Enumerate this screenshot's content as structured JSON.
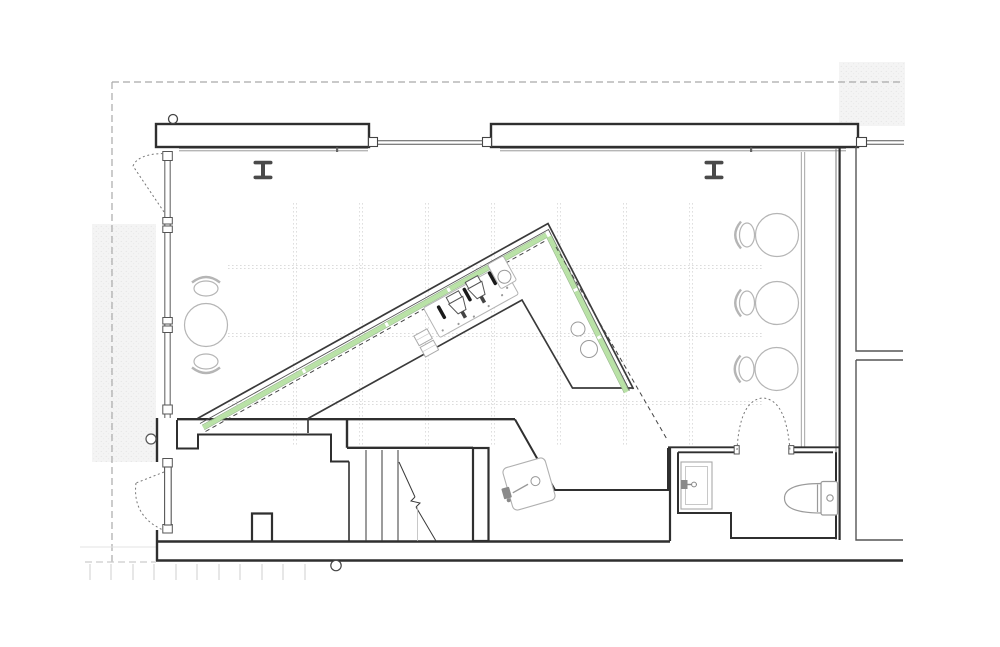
{
  "drawing": {
    "type": "architectural-floor-plan",
    "view": "cafe-floor-plan",
    "colors": {
      "paper": "#ffffff",
      "wall_dark": "#2f2f2f",
      "line_medium": "#555555",
      "line_light": "#9a9a9a",
      "furniture_gray": "#b5b5b5",
      "accent_green": "#b9e2a6",
      "accent_green_border": "#93b388",
      "stipple_fill": "#f2f2f2",
      "grid_dot": "#dcdcdc",
      "swing_dot": "#777777"
    },
    "symbols": {
      "columns_i_beam": 2,
      "round_tables": 4,
      "chairs": 5,
      "door_swings": 4,
      "counter_sink_circles": 2,
      "scale_ticks": 11
    },
    "elements": [
      "property-line-dashed",
      "storefront-glazing",
      "entry-door-swing",
      "i-beam-column",
      "planning-grid",
      "bar-counter",
      "counter-accent-strip",
      "espresso-machine",
      "coffee-grinder",
      "counter-sinks",
      "prep-sink",
      "stair",
      "round-table",
      "chair",
      "wc-room",
      "toilet",
      "vanity-sink",
      "adjacent-structure",
      "scale-ticks"
    ]
  }
}
